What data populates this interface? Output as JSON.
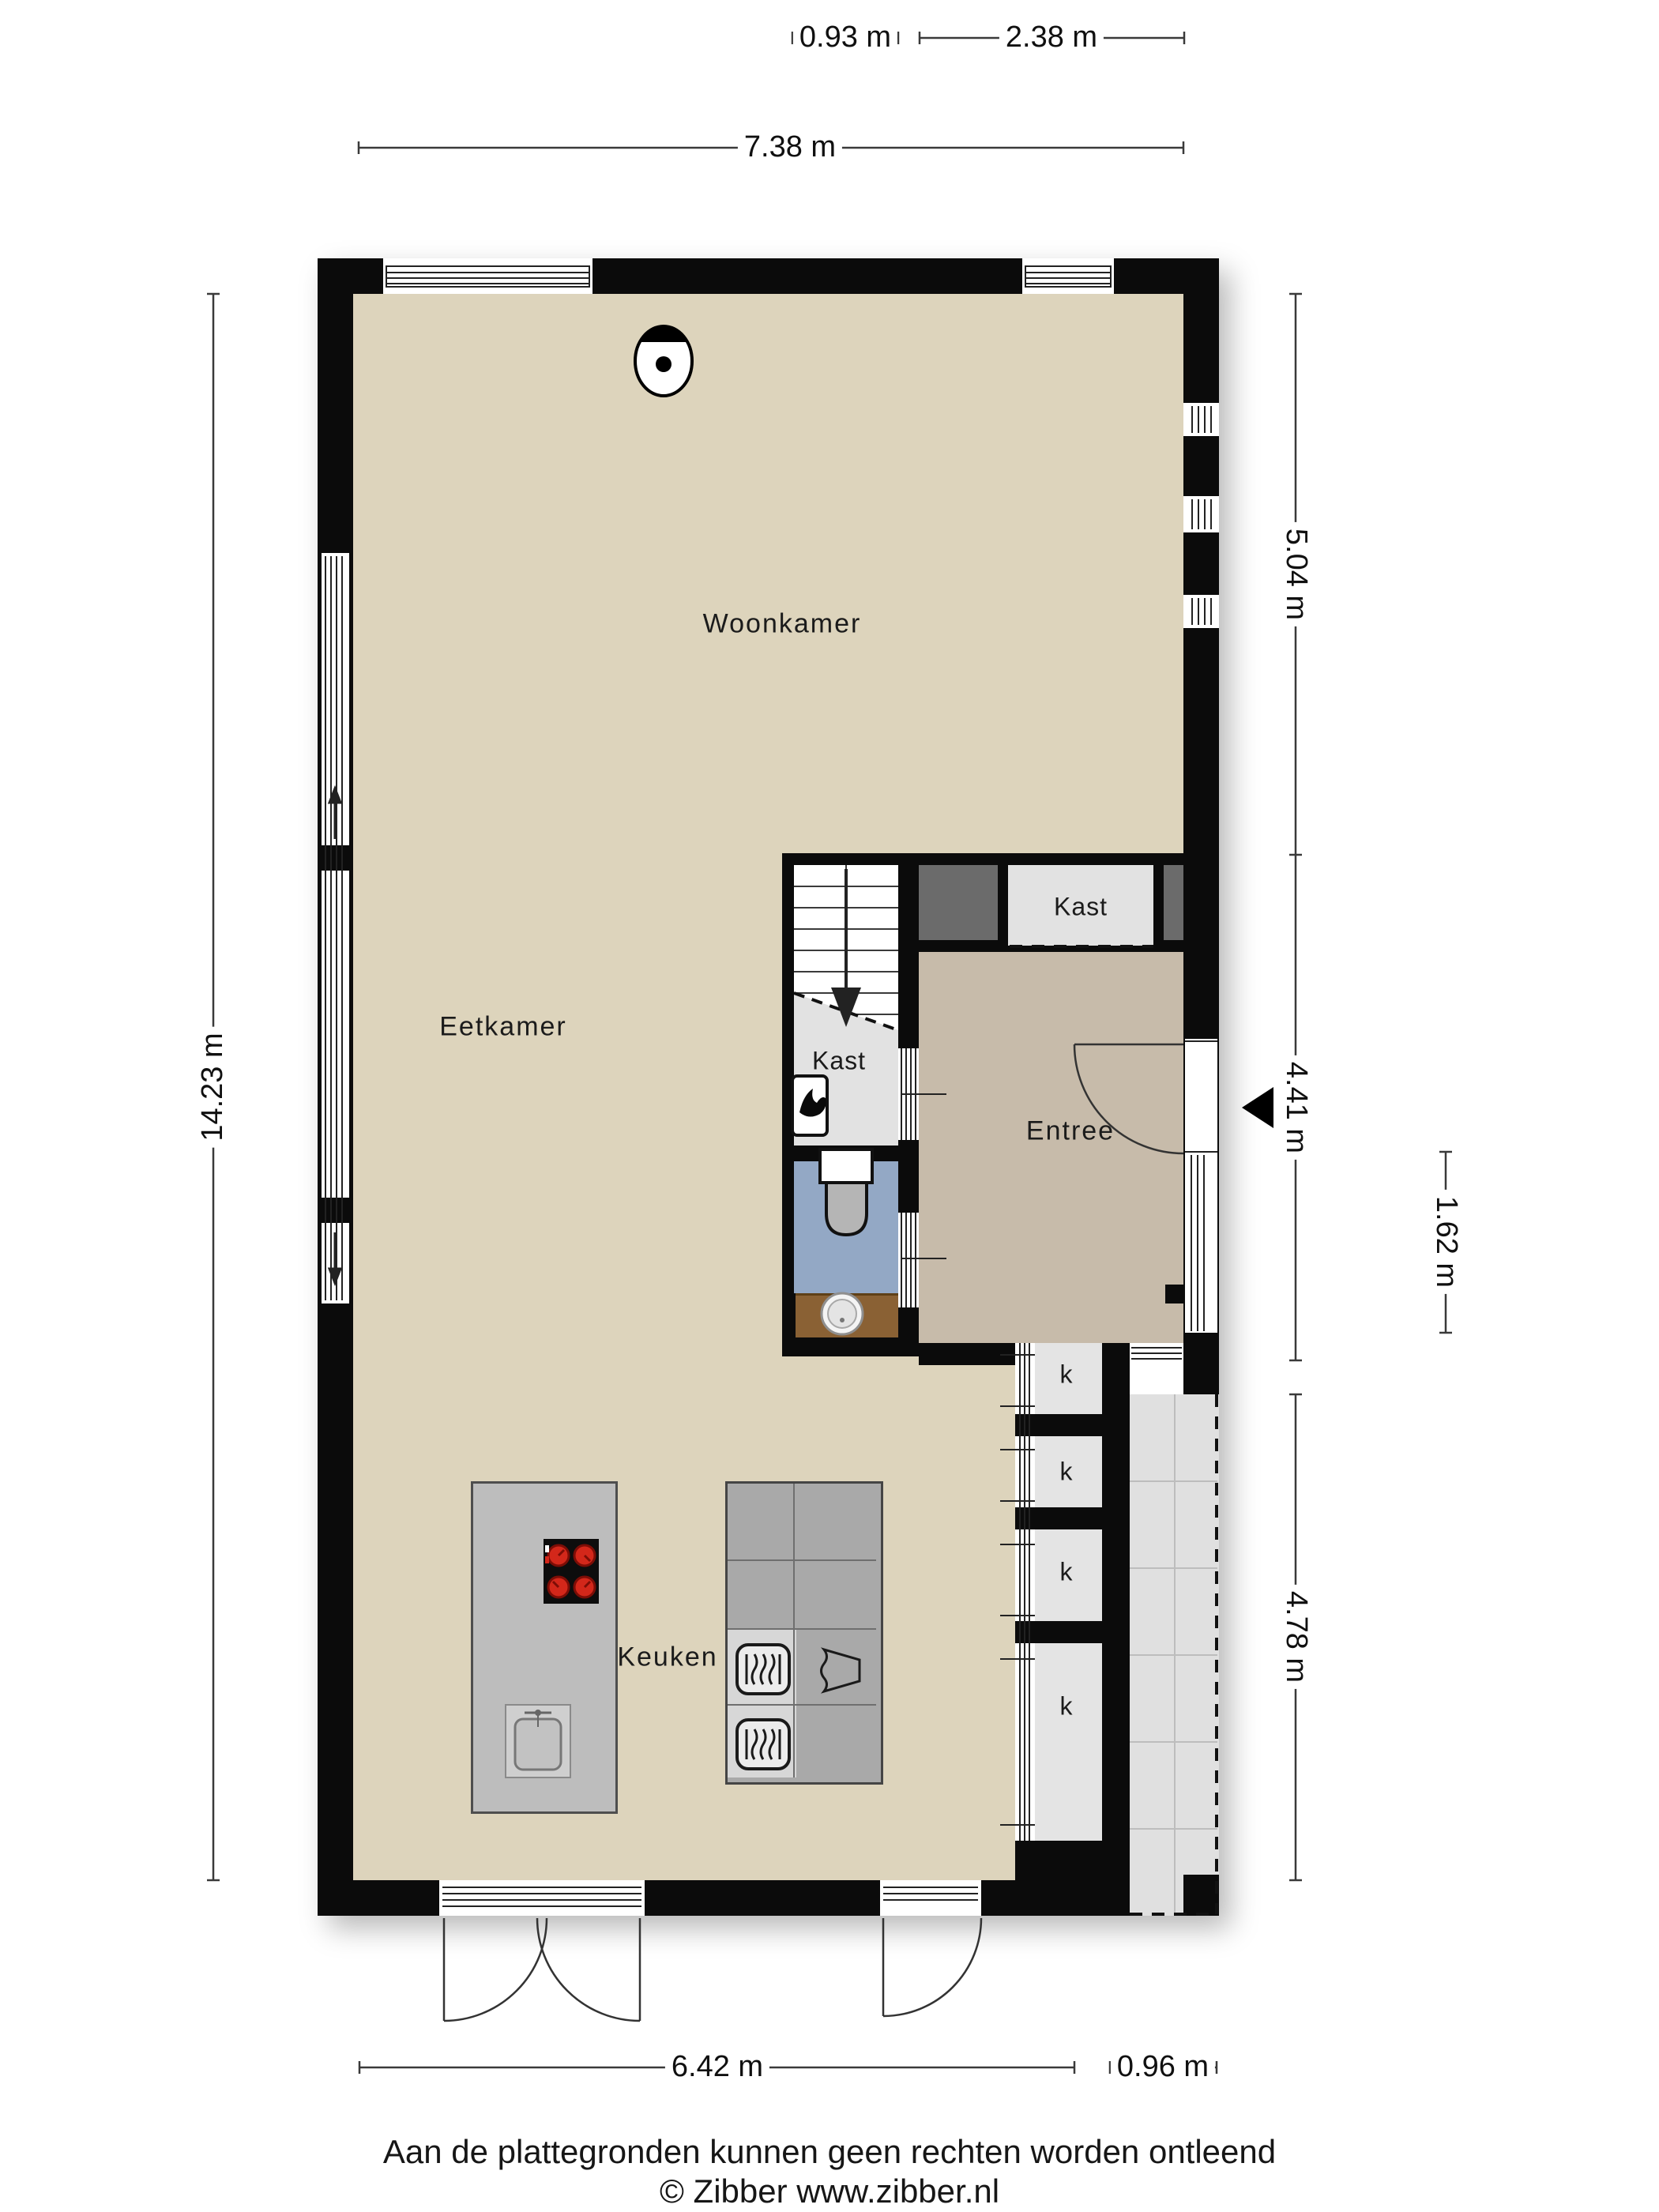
{
  "plan": {
    "rooms": {
      "woonkamer": "Woonkamer",
      "eetkamer": "Eetkamer",
      "keuken": "Keuken",
      "entree": "Entree",
      "kast_upper": "Kast",
      "kast_under_stairs": "Kast",
      "closet_marker": "k"
    },
    "dimensions": {
      "top_small_left": "0.93 m",
      "top_small_right": "2.38 m",
      "top_total": "7.38 m",
      "left_total": "14.23 m",
      "right_upper": "5.04 m",
      "right_middle": "4.41 m",
      "right_inner": "1.62 m",
      "right_lower": "4.78 m",
      "bottom_main": "6.42 m",
      "bottom_right": "0.96 m"
    },
    "footer": {
      "disclaimer": "Aan de plattegronden kunnen geen rechten worden ontleend",
      "copyright": "© Zibber www.zibber.nl"
    },
    "colors": {
      "wall": "#0b0b0b",
      "floor_main": "#ddd4bc",
      "floor_entree": "#c7bbaa",
      "floor_closet": "#e2e2e2",
      "floor_toilet": "#93a8c5",
      "floor_terrace": "#e0e0e0",
      "floor_niche": "#e4e4e4",
      "dark_closet": "#6b6b6b",
      "island": "#bdbdbd",
      "counter": "#a9a9a9",
      "counter_light": "#d7d7d7",
      "vanity_wood": "#8a6134",
      "burner_red": "#d3271a"
    }
  }
}
